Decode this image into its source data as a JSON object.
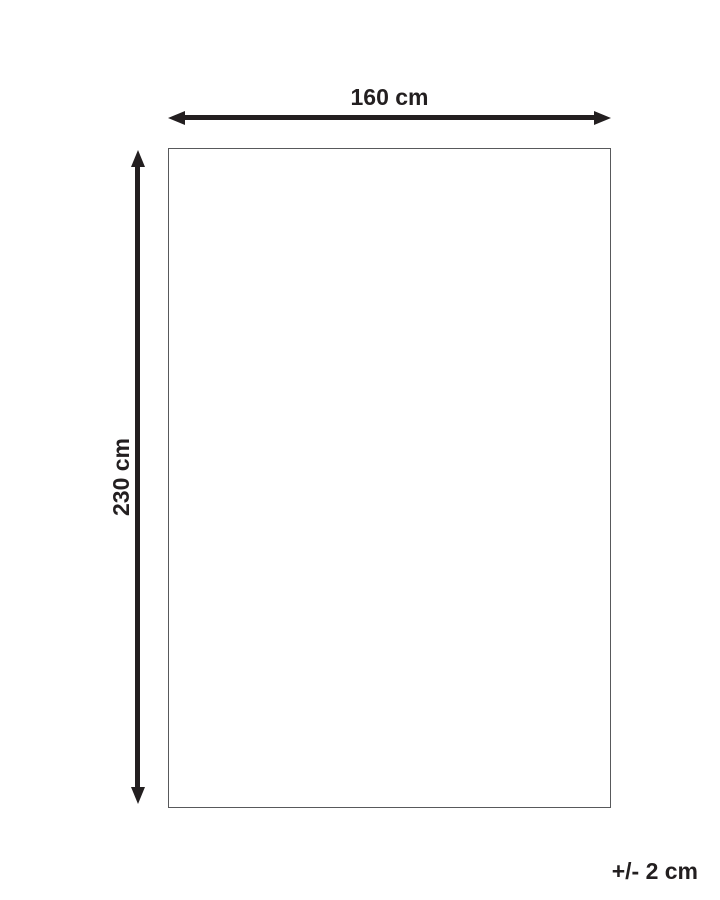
{
  "diagram": {
    "title": "product-dimension-diagram",
    "width_label": "160 cm",
    "height_label": "230 cm",
    "tolerance_label": "+/- 2 cm",
    "shape": {
      "type": "rectangle",
      "width_cm": 160,
      "height_cm": 230,
      "tolerance_cm": 2
    },
    "colors": {
      "arrow": "#231f20",
      "text": "#231f20",
      "rect-border": "#58595b",
      "bg": "#ffffff"
    }
  }
}
